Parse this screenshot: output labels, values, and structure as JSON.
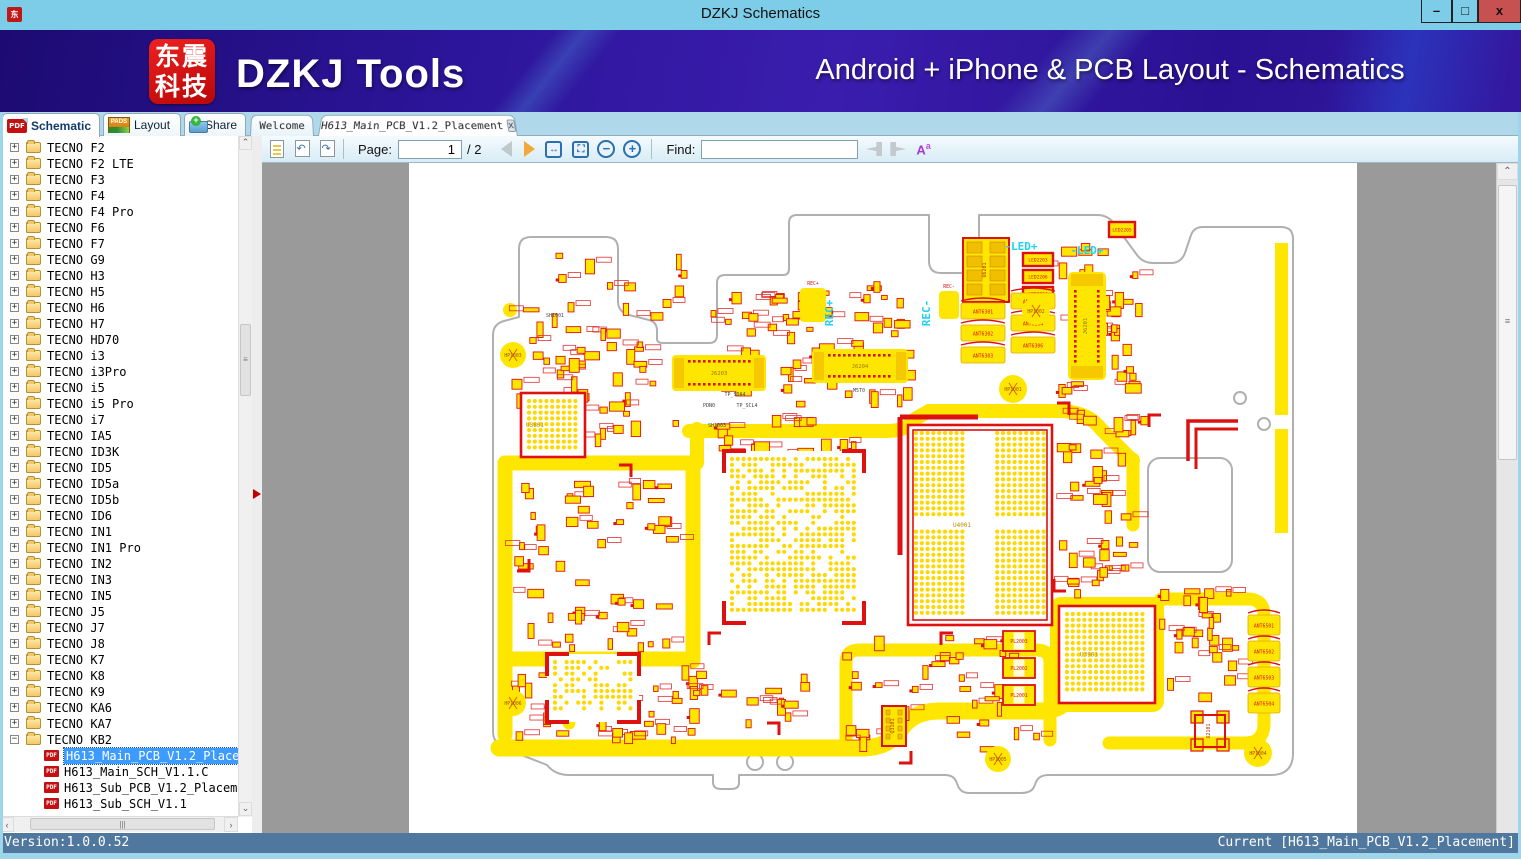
{
  "window": {
    "title": "DZKJ Schematics",
    "controls": {
      "minimize": "–",
      "maximize": "□",
      "close": "x"
    }
  },
  "banner": {
    "logo_line1": "东震",
    "logo_line2": "科技",
    "brand": "DZKJ Tools",
    "tagline": "Android + iPhone & PCB Layout - Schematics"
  },
  "main_tabs": [
    {
      "label": "Schematic",
      "icon": "pdf-icon",
      "active": true
    },
    {
      "label": "Layout",
      "icon": "pads-icon",
      "active": false
    },
    {
      "label": "Share",
      "icon": "share-folder-icon",
      "active": false
    }
  ],
  "doc_tabs": [
    {
      "label": "Welcome",
      "active": false,
      "closable": false
    },
    {
      "label": "H613_Main_PCB_V1.2_Placement",
      "active": true,
      "closable": true
    }
  ],
  "toolbar": {
    "page_label": "Page:",
    "page_value": "1",
    "page_total": "/ 2",
    "find_label": "Find:",
    "find_value": "",
    "case_icon": "Aa"
  },
  "sidebar": {
    "folders": [
      "TECNO F2",
      "TECNO F2 LTE",
      "TECNO F3",
      "TECNO F4",
      "TECNO F4 Pro",
      "TECNO F6",
      "TECNO F7",
      "TECNO G9",
      "TECNO H3",
      "TECNO H5",
      "TECNO H6",
      "TECNO H7",
      "TECNO HD70",
      "TECNO i3",
      "TECNO i3Pro",
      "TECNO i5",
      "TECNO i5 Pro",
      "TECNO i7",
      "TECNO IA5",
      "TECNO ID3K",
      "TECNO ID5",
      "TECNO ID5a",
      "TECNO ID5b",
      "TECNO ID6",
      "TECNO IN1",
      "TECNO IN1 Pro",
      "TECNO IN2",
      "TECNO IN3",
      "TECNO IN5",
      "TECNO J5",
      "TECNO J7",
      "TECNO J8",
      "TECNO K7",
      "TECNO K8",
      "TECNO K9",
      "TECNO KA6",
      "TECNO KA7",
      "TECNO KB2"
    ],
    "expanded_folder": "TECNO KB2",
    "children": [
      {
        "label": "H613_Main_PCB_V1.2_Placement",
        "selected": true
      },
      {
        "label": "H613_Main_SCH_V1.1.C",
        "selected": false
      },
      {
        "label": "H613_Sub_PCB_V1.2_Placement",
        "selected": false
      },
      {
        "label": "H613_Sub_SCH_V1.1",
        "selected": false
      }
    ]
  },
  "statusbar": {
    "version": "Version:1.0.0.52",
    "current": "Current [H613_Main_PCB_V1.2_Placement]"
  },
  "pcb": {
    "colors": {
      "yellow": "#FFE600",
      "dot": "#FFD800",
      "red": "#DE1010",
      "outline": "#B0B0B0",
      "cyan": "#1FD3EE"
    },
    "cyan_labels": [
      {
        "text": "REC+",
        "x": 424,
        "y": 150,
        "rot": -90
      },
      {
        "text": "REC-",
        "x": 521,
        "y": 150,
        "rot": -90
      },
      {
        "text": "-LED+",
        "x": 612,
        "y": 87,
        "rot": 0
      },
      {
        "text": "-LED+",
        "x": 678,
        "y": 91,
        "rot": 0
      }
    ],
    "dark_labels": [
      {
        "text": "SH1001",
        "x": 146,
        "y": 154
      },
      {
        "text": "SH1003",
        "x": 308,
        "y": 264
      },
      {
        "text": "PDN0",
        "x": 300,
        "y": 244
      },
      {
        "text": "TP_SDA4",
        "x": 326,
        "y": 233
      },
      {
        "text": "TP_SCL4",
        "x": 338,
        "y": 244
      },
      {
        "text": "M5T0",
        "x": 450,
        "y": 229
      }
    ],
    "components": [
      {
        "t": "bga",
        "x": 499,
        "y": 262,
        "w": 144,
        "h": 200,
        "label": "U4001",
        "quad": true,
        "frame": 2
      },
      {
        "t": "bga",
        "x": 315,
        "y": 288,
        "w": 140,
        "h": 172,
        "label": "",
        "miss": 0.3,
        "brackets": true
      },
      {
        "t": "bga",
        "x": 650,
        "y": 443,
        "w": 96,
        "h": 97,
        "label": "U3901",
        "frame": 1
      },
      {
        "t": "bga",
        "x": 112,
        "y": 230,
        "w": 64,
        "h": 64,
        "label": "U3801",
        "frame": 1
      },
      {
        "t": "bga",
        "x": 138,
        "y": 491,
        "w": 92,
        "h": 68,
        "label": "",
        "miss": 0.35,
        "brackets": true
      },
      {
        "t": "connh",
        "x": 263,
        "y": 192,
        "w": 94,
        "h": 36,
        "label": "J6203"
      },
      {
        "t": "connh",
        "x": 403,
        "y": 186,
        "w": 96,
        "h": 34,
        "label": "J6204"
      },
      {
        "t": "connv",
        "x": 659,
        "y": 109,
        "w": 38,
        "h": 108,
        "label": "J6201"
      },
      {
        "t": "padblock",
        "x": 554,
        "y": 75,
        "w": 46,
        "h": 64,
        "label": "U6201"
      },
      {
        "t": "led",
        "x": 700,
        "y": 59,
        "w": 26,
        "h": 15,
        "label": "LED2205"
      },
      {
        "t": "led",
        "x": 614,
        "y": 90,
        "w": 30,
        "h": 13,
        "label": "LED2203"
      },
      {
        "t": "led",
        "x": 614,
        "y": 107,
        "w": 30,
        "h": 13,
        "label": "LED2206"
      },
      {
        "t": "led",
        "x": 614,
        "y": 124,
        "w": 30,
        "h": 13,
        "label": "LED2204"
      },
      {
        "t": "ant",
        "x": 552,
        "y": 140,
        "w": 44,
        "h": 16,
        "label": "ANT6301"
      },
      {
        "t": "ant",
        "x": 552,
        "y": 162,
        "w": 44,
        "h": 16,
        "label": "ANT6302"
      },
      {
        "t": "ant",
        "x": 552,
        "y": 184,
        "w": 44,
        "h": 16,
        "label": "ANT6303"
      },
      {
        "t": "ant",
        "x": 602,
        "y": 130,
        "w": 44,
        "h": 16,
        "label": "ANT6305"
      },
      {
        "t": "ant",
        "x": 602,
        "y": 152,
        "w": 44,
        "h": 16,
        "label": "ANT6304"
      },
      {
        "t": "ant",
        "x": 602,
        "y": 174,
        "w": 44,
        "h": 16,
        "label": "ANT6306"
      },
      {
        "t": "ant",
        "x": 839,
        "y": 452,
        "w": 32,
        "h": 20,
        "label": "ANT6501"
      },
      {
        "t": "ant",
        "x": 839,
        "y": 478,
        "w": 32,
        "h": 20,
        "label": "ANT6502"
      },
      {
        "t": "ant",
        "x": 839,
        "y": 504,
        "w": 32,
        "h": 20,
        "label": "ANT6503"
      },
      {
        "t": "ant",
        "x": 839,
        "y": 530,
        "w": 32,
        "h": 20,
        "label": "ANT6504"
      },
      {
        "t": "circle",
        "x": 104,
        "y": 192,
        "r": 13,
        "label": "HP1003"
      },
      {
        "t": "circle",
        "x": 627,
        "y": 148,
        "r": 14,
        "label": "HP1002"
      },
      {
        "t": "circle",
        "x": 604,
        "y": 226,
        "r": 14,
        "label": "HP1001"
      },
      {
        "t": "circle",
        "x": 589,
        "y": 596,
        "r": 13,
        "label": "HP1005"
      },
      {
        "t": "circle",
        "x": 849,
        "y": 590,
        "r": 14,
        "label": "HP1004"
      },
      {
        "t": "circle",
        "x": 104,
        "y": 540,
        "r": 13,
        "label": "HP1006"
      },
      {
        "t": "pad",
        "x": 391,
        "y": 125,
        "w": 26,
        "h": 34,
        "label": "REC+"
      },
      {
        "t": "pad",
        "x": 530,
        "y": 128,
        "w": 20,
        "h": 28,
        "label": "REC-"
      },
      {
        "t": "padblock",
        "x": 473,
        "y": 543,
        "w": 24,
        "h": 40,
        "label": "Q3101"
      },
      {
        "t": "block",
        "x": 594,
        "y": 468,
        "w": 32,
        "h": 20,
        "label": "PL2003"
      },
      {
        "t": "block",
        "x": 594,
        "y": 495,
        "w": 32,
        "h": 20,
        "label": "PL2002"
      },
      {
        "t": "block",
        "x": 594,
        "y": 522,
        "w": 32,
        "h": 20,
        "label": "PL2001"
      },
      {
        "t": "corner4",
        "x": 782,
        "y": 548,
        "w": 38,
        "h": 40,
        "label": "X2101"
      }
    ]
  }
}
